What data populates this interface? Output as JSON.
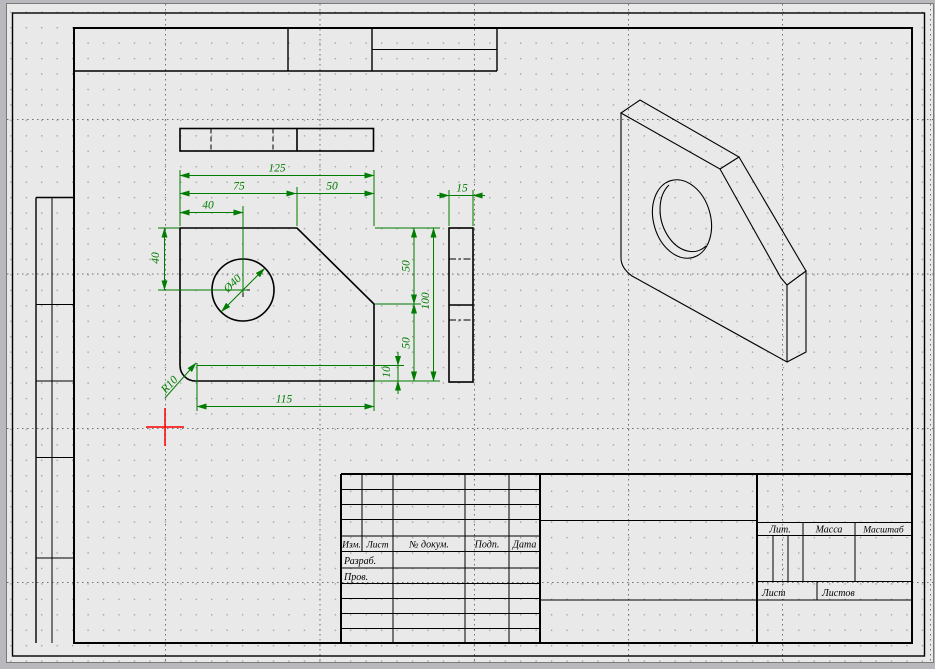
{
  "app": {
    "background": "#b9b9bd",
    "paper_color": "#e9e9e9",
    "dimension_color": "#007c00",
    "drawing_color": "#000000",
    "origin_marker_color": "#ff0000"
  },
  "dimensions": {
    "top_width": "125",
    "top_left_segment": "75",
    "top_right_segment": "50",
    "hole_offset_x": "40",
    "left_height": "40",
    "right_upper": "50",
    "right_total": "100",
    "right_lower": "50",
    "bottom_offset": "10",
    "bottom_length": "115",
    "thickness": "15",
    "hole_diameter": "Ø40",
    "corner_radius": "R10"
  },
  "title_block": {
    "change_header": {
      "izm": "Изм.",
      "list": "Лист",
      "doc_no": "№ докум.",
      "sign": "Подп.",
      "date": "Дата"
    },
    "staff_rows": {
      "developed": "Разраб.",
      "checked": "Пров."
    },
    "right_section": {
      "lit": "Лит.",
      "mass": "Масса",
      "scale": "Масштаб",
      "sheet": "Лист",
      "sheets": "Листов"
    }
  }
}
